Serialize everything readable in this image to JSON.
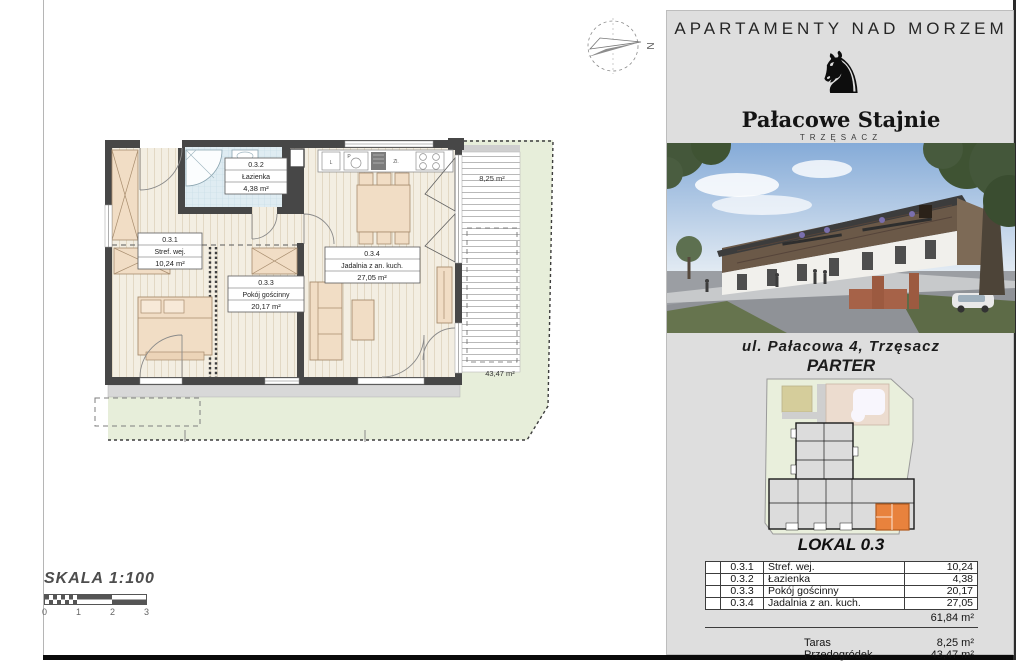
{
  "page": {
    "scale_label": "SKALA 1:100",
    "scale_ticks": [
      "0",
      "1",
      "2",
      "3"
    ],
    "compass_letter": "N"
  },
  "plan": {
    "rooms": [
      {
        "no": "0.3.1",
        "name": "Stref. wej.",
        "area": "10,24 m²"
      },
      {
        "no": "0.3.2",
        "name": "Łazienka",
        "area": "4,38 m²"
      },
      {
        "no": "0.3.3",
        "name": "Pokój gościnny",
        "area": "20,17 m²"
      },
      {
        "no": "0.3.4",
        "name": "Jadalnia z an. kuch.",
        "area": "27,05 m²"
      }
    ],
    "terrace_area": "8,25 m²",
    "garden_area": "43,47 m²",
    "kitchen_labels": {
      "l": "L",
      "p": "P",
      "zl": "Zl."
    }
  },
  "sidebar": {
    "title": "APARTAMENTY NAD MORZEM",
    "brand": {
      "knight": "♞",
      "name": "Pałacowe Stajnie",
      "city": "TRZĘSACZ"
    },
    "address": "ul. Pałacowa 4, Trzęsacz",
    "floor_label": "PARTER",
    "unit_label": "LOKAL 0.3",
    "table": {
      "rows": [
        {
          "no": "0.3.1",
          "name": "Stref. wej.",
          "value": "10,24"
        },
        {
          "no": "0.3.2",
          "name": "Łazienka",
          "value": "4,38"
        },
        {
          "no": "0.3.3",
          "name": "Pokój gościnny",
          "value": "20,17"
        },
        {
          "no": "0.3.4",
          "name": "Jadalnia z an. kuch.",
          "value": "27,05"
        }
      ],
      "total": "61,84 m²",
      "extras": [
        {
          "label": "Taras",
          "value": "8,25 m²"
        },
        {
          "label": "Przedogródek",
          "value": "43,47 m²"
        }
      ]
    }
  },
  "colors": {
    "highlight_unit": "#e8823d",
    "garden_green": "#e7eeda",
    "bathroom_blue": "#dfecf2",
    "wall_gray": "#474747",
    "furniture_tan": "#f1ddc5"
  }
}
